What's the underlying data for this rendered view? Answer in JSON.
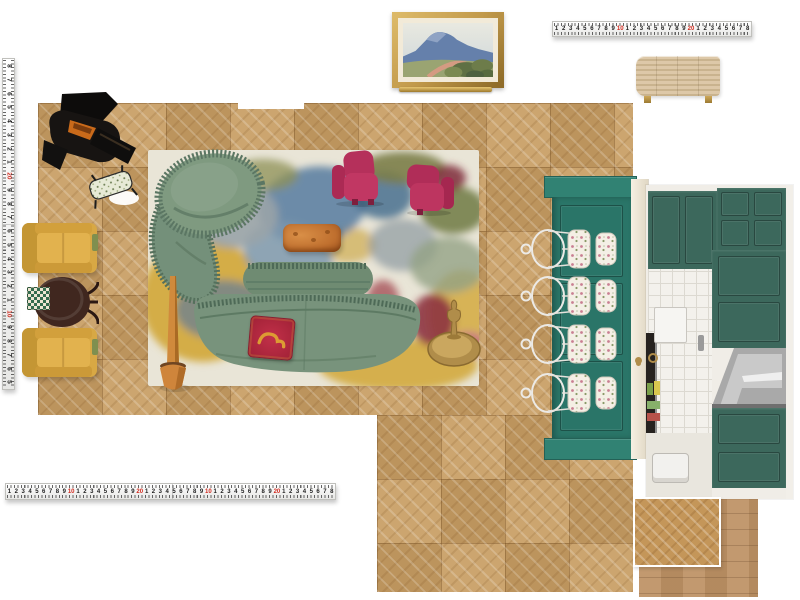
{
  "canvas": {
    "background": "#ffffff",
    "width": 800,
    "height": 600
  },
  "palette": {
    "bg": "#ffffff",
    "wood": "#c89d63",
    "teal": "#2a7568",
    "teal_light": "#318273",
    "cab_green": "#3c685c",
    "sofa_green": "#78937c",
    "sage": "#7f9a80",
    "fringe_green": "#4e6a57",
    "pink": "#b5305b",
    "yellow": "#d8a844",
    "rug_base": "#e9e5d7",
    "mustard": "#d3aa3e",
    "pillow_red": "#b32740",
    "brass": "#b08d4a",
    "terracotta": "#cf853b",
    "frame_gold": "#c29a4b",
    "ruler_red": "#d22a1e",
    "tile": "#f3f1ec",
    "steel": "#b9b9b9",
    "table_brown": "#40271f",
    "swatch_plank": "#bd9164"
  },
  "rulers": {
    "red_values": [
      10,
      20
    ],
    "top": {
      "numbers": [
        1,
        2,
        3,
        4,
        5,
        6,
        7,
        8,
        9,
        10,
        1,
        2,
        3,
        4,
        5,
        6,
        7,
        8,
        9,
        20,
        1,
        2,
        3,
        4,
        5,
        6,
        7,
        8
      ]
    },
    "left": {
      "numbers": [
        8,
        7,
        6,
        5,
        4,
        3,
        2,
        1,
        20,
        9,
        8,
        7,
        6,
        5,
        4,
        3,
        2,
        1,
        10,
        9,
        8,
        7,
        6,
        5
      ]
    },
    "bottom": {
      "numbers": [
        1,
        2,
        3,
        4,
        5,
        6,
        7,
        8,
        9,
        10,
        1,
        2,
        3,
        4,
        5,
        6,
        7,
        8,
        9,
        20,
        1,
        2,
        3,
        4,
        5,
        6,
        7,
        8,
        9,
        10,
        1,
        2,
        3,
        4,
        5,
        6,
        7,
        8,
        9,
        20,
        1,
        2,
        3,
        4,
        5,
        6,
        7,
        8
      ]
    }
  },
  "items": {
    "wall_art": {
      "name": "framed coastal landscape painting"
    },
    "picture_ledge": {
      "name": "gold picture ledge"
    },
    "sideboard": {
      "name": "fluted oak sideboard with brass legs"
    },
    "piano": {
      "name": "black grand piano with floral bench"
    },
    "game_table": {
      "name": "round pedestal table with checkerboard"
    },
    "armchairs_yellow": {
      "count": 2,
      "name": "mustard armchair"
    },
    "rug": {
      "name": "abstract floral area rug"
    },
    "chaise": {
      "name": "sage fringed curved chaise"
    },
    "accent_chairs_pink": {
      "count": 2,
      "name": "raspberry sculptural accent chair"
    },
    "ottoman": {
      "name": "burl orange ottoman bench"
    },
    "sofa": {
      "name": "sage serpentine fringed sofa"
    },
    "pillow": {
      "name": "red throw pillow with gold motif"
    },
    "planter": {
      "name": "terracotta floor planter"
    },
    "side_table": {
      "name": "brass drum side table with figurine"
    },
    "island": {
      "name": "teal kitchen island",
      "stool_count": 4
    },
    "kitchen": {
      "name": "green kitchen with tile backsplash and steel hood"
    },
    "floor": {
      "name": "chevron parquet floor"
    },
    "swatches": {
      "chevron": "herringbone wood swatch",
      "plank": "plank wood swatch"
    }
  }
}
